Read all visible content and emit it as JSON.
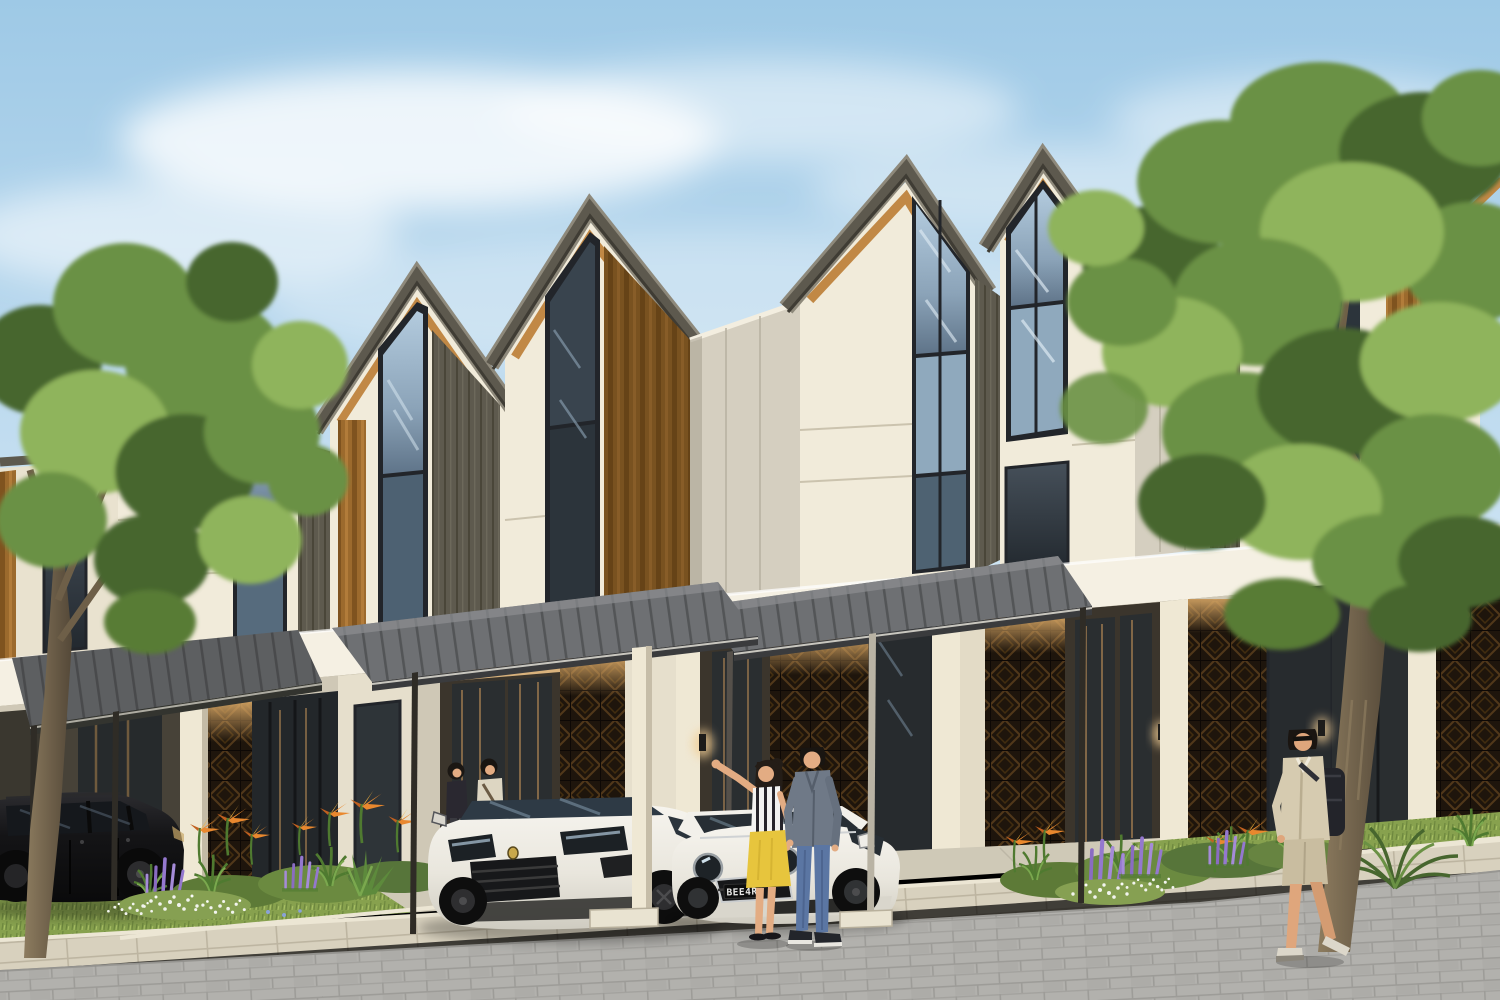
{
  "meta": {
    "title": "Modern townhouse row exterior render",
    "type": "architectural-visualization",
    "time_of_day": "day"
  },
  "palette": {
    "sky_top": "#9ec9e6",
    "sky_mid": "#c2ddf0",
    "sky_low": "#e2f0f8",
    "cloud": "#ffffff",
    "roof_frame": "#5d594e",
    "roof_frame_dark": "#3f3c34",
    "roof_edge_light": "#8e897b",
    "wood": "#c18845",
    "wood_dark": "#8a5a26",
    "panel_cream": "#f1ebda",
    "panel_shade": "#ddd5c2",
    "panel_recessed": "#d5cfc0",
    "siding_olive": "#5e5a4e",
    "siding_line": "#4a4639",
    "glass_dark": "#333b44",
    "glass_sky": "#9db8cd",
    "glass_frame": "#22252a",
    "fascia": "#f5f0e3",
    "soffit": "#c2a678",
    "glow": "#e3bd87",
    "breeze_bg": "#1e150c",
    "breeze_motif": "#7a5526",
    "canopy_top": "#6e7073",
    "canopy_slat": "#535557",
    "canopy_edge": "#3a3b3d",
    "post_dark": "#2f2c26",
    "column_cream": "#efe8d4",
    "grass": "#87a14e",
    "grass_light": "#a9c164",
    "grass_dark": "#69833c",
    "foliage_light": "#8fb45c",
    "foliage_mid": "#6a9144",
    "foliage_dark": "#47662e",
    "trunk": "#6f6047",
    "trunk_light": "#8d7c5f",
    "flower_purple": "#9478cf",
    "flower_orange": "#e9882e",
    "flower_white": "#f2f4ee",
    "sidewalk": "#d8d1be",
    "curb": "#ece6d4",
    "road": "#b2b1ad",
    "road_joint": "#9d9c98",
    "apron": "#cfc9b7",
    "car_black": "#17171a",
    "car_white": "#ebe8e0",
    "wheel": "#141414",
    "skin": "#e3ac83",
    "hair": "#221c16",
    "top_stripe_light": "#f3f3f1",
    "top_stripe_dark": "#26242a",
    "skirt_yellow": "#e7c53d",
    "denim_jacket": "#6f7987",
    "jeans": "#5b76a3",
    "sweater_cream": "#ddd6c2",
    "outfit_black": "#2a2830",
    "cardigan_beige": "#d6cbb0",
    "shorts_khaki": "#c9bda0",
    "backpack": "#23242a",
    "sneaker_light": "#dcd7ca"
  },
  "scene": {
    "setting": "row of two-storey modern townhouses with steep gable roofs, daytime",
    "sky": {
      "description": "clear blue sky with soft white clouds"
    },
    "buildings": {
      "unit_count": 6,
      "units": [
        {
          "id": "unit-1",
          "features": "steep gable, wood trim, vertical wood strip, tall sky-reflecting window"
        },
        {
          "id": "unit-2",
          "features": "steep gable, wood trim, tall window near apex, olive siding band"
        },
        {
          "id": "unit-3",
          "features": "tallest near gable, wide dark timber slab, narrow apex window"
        },
        {
          "id": "unit-4",
          "features": "gable with wood-lined eaves, full-height glazed strip"
        },
        {
          "id": "unit-5",
          "features": "gable with large sky-lit corner window"
        },
        {
          "id": "unit-6",
          "features": "gable mostly hidden behind large tree"
        }
      ],
      "materials": [
        "dark metal roof frames",
        "teak wood accents",
        "cream wall panels",
        "olive vertical siding",
        "perforated dark screen blocks",
        "glass doors with warm interior light"
      ]
    },
    "carports": {
      "count": 3,
      "style": "flat slatted steel canopies on slim posts with white curb bases"
    },
    "lighting": [
      "warm soffit glow at entrances",
      "wall lamps"
    ]
  },
  "vehicles": {
    "black_suv": {
      "color": "black",
      "type": "SUV",
      "position": "left carport"
    },
    "white_suv": {
      "color": "white",
      "type": "luxury SUV",
      "position": "center carport"
    },
    "mini": {
      "color": "white",
      "type": "compact hatchback",
      "position": "right carport",
      "plate": "BEE4R"
    }
  },
  "people": [
    {
      "id": "host-woman",
      "outfit": "black top, dark trousers",
      "position": "entrance porch"
    },
    {
      "id": "host-man",
      "outfit": "cream sweater with shoulder bag",
      "position": "entrance porch"
    },
    {
      "id": "waving-woman",
      "outfit": "black-white striped sleeveless top, yellow pencil skirt, black flats",
      "pose": "waving"
    },
    {
      "id": "partner-man",
      "outfit": "gray denim jacket, blue jeans, dark sneakers",
      "pose": "standing by car"
    },
    {
      "id": "walking-man",
      "outfit": "beige cardigan, khaki shorts, black backpack, sunglasses",
      "pose": "walking on sidewalk"
    }
  ],
  "landscaping": {
    "trees": [
      "foreground tree at left",
      "large leafy tree at right"
    ],
    "flowers": [
      "orange bird-of-paradise",
      "purple salvia spikes",
      "white ground flowers"
    ],
    "lawn": "clipped grass strip with flower beds",
    "hardscape": [
      "pale long-paver sidewalk",
      "gray block road",
      "concrete driveway court",
      "white curb edging"
    ]
  }
}
